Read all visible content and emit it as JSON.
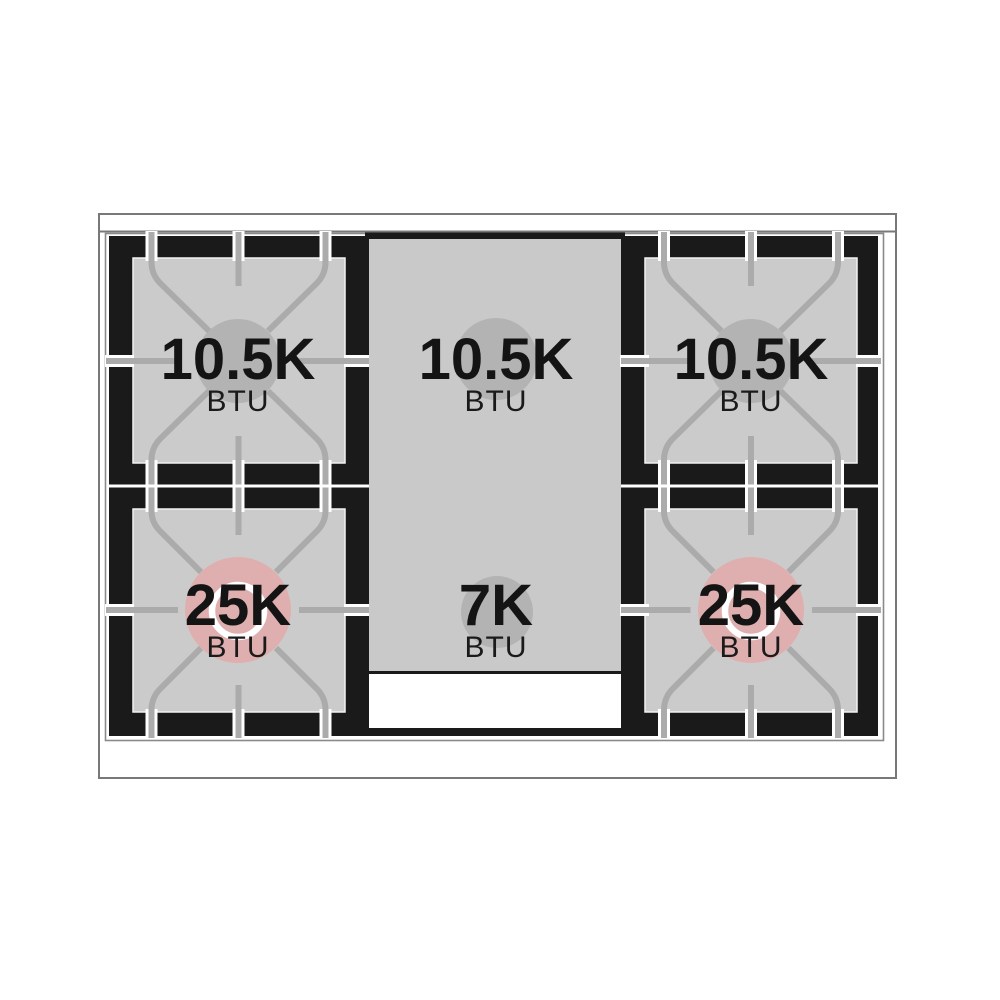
{
  "diagram": {
    "name": "gas-range-cooktop-burner-btu-diagram",
    "colors": {
      "frame_black": "#1a1a1a",
      "surface_grey": "#cbcbcb",
      "griddle_grey": "#c9c9c9",
      "flame_grey": "#b3b3b3",
      "flame_pink": "#dfafaf",
      "grate_grey": "#ababab",
      "panel_white": "#ffffff"
    },
    "burners": [
      {
        "id": "top-left",
        "value": "10.5K",
        "unit": "BTU"
      },
      {
        "id": "top-center",
        "value": "10.5K",
        "unit": "BTU"
      },
      {
        "id": "top-right",
        "value": "10.5K",
        "unit": "BTU"
      },
      {
        "id": "bottom-left",
        "value": "25K",
        "unit": "BTU"
      },
      {
        "id": "bottom-center",
        "value": "7K",
        "unit": "BTU"
      },
      {
        "id": "bottom-right",
        "value": "25K",
        "unit": "BTU"
      }
    ]
  }
}
